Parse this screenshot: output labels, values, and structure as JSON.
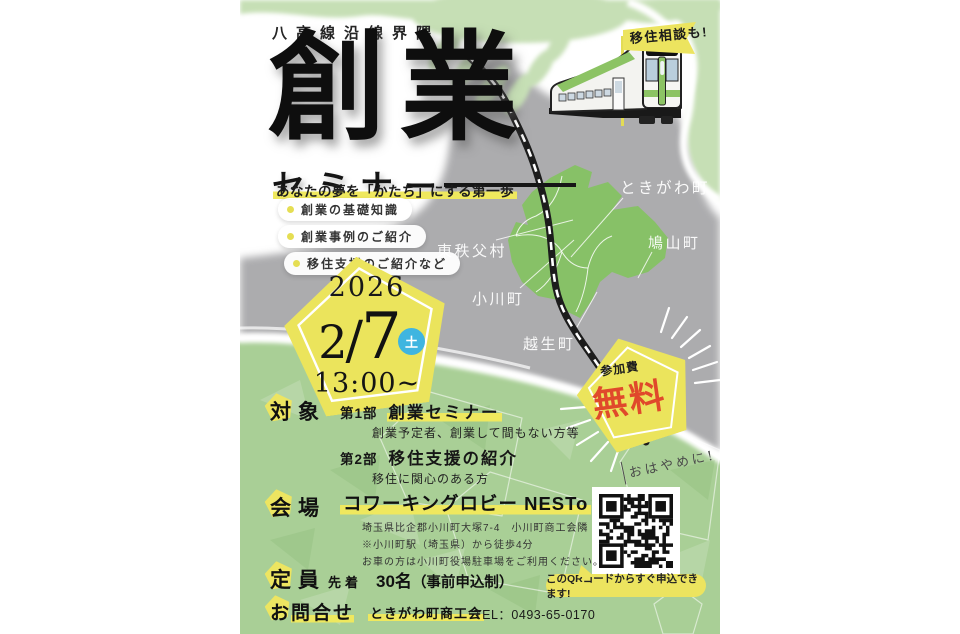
{
  "poster": {
    "header": {
      "kicker": "八高線沿線界隈",
      "title": "創業",
      "subtitle": "セミナー",
      "tagline": "あなたの夢を「かたち」にする第一歩",
      "bullets": [
        "創業の基礎知識",
        "創業事例のご紹介",
        "移住支援のご紹介など"
      ]
    },
    "flag": {
      "label": "移住相談も!"
    },
    "date_badge": {
      "year": "2026",
      "month": "2",
      "slash": "/",
      "day": "7",
      "weekday": "土",
      "time": "13:00~"
    },
    "map": {
      "towns": [
        "ときがわ町",
        "鳩山町",
        "東秩父村",
        "小川町",
        "越生町"
      ]
    },
    "fee_badge": {
      "label": "参加費",
      "value": "無料"
    },
    "qr": {
      "note": "おはやめに!",
      "bubble": "このQRコードからすぐ申込できます!"
    },
    "sections": {
      "target": {
        "label_first": "対",
        "label_rest": "象",
        "part1_no": "第1部",
        "part1_title": "創業セミナー",
        "part1_desc": "創業予定者、創業して間もない方等",
        "part2_no": "第2部",
        "part2_title": "移住支援の紹介",
        "part2_desc": "移住に関心のある方"
      },
      "venue": {
        "label_first": "会",
        "label_rest": "場",
        "name": "コワーキングロビー NESTo",
        "lines": [
          "埼玉県比企郡小川町大塚7-4　小川町商工会隣",
          "※小川町駅（埼玉県）から徒歩4分",
          "お車の方は小川町役場駐車場をご利用ください。"
        ]
      },
      "capacity": {
        "label_first": "定",
        "label_rest": "員",
        "prefix": "先着",
        "value": "30名",
        "suffix": "（事前申込制）"
      },
      "contact": {
        "label_first": "お",
        "label_rest": "問合せ",
        "org": "ときがわ町商工会",
        "tel": "TEL：0493-65-0170"
      }
    },
    "colors": {
      "accent_yellow": "#ece45f",
      "map_green": "#87c167",
      "background_gray": "#acacae",
      "bottom_green": "#a9cf96",
      "free_red": "#e0492b",
      "weekday_blue": "#3fb5e0"
    }
  }
}
